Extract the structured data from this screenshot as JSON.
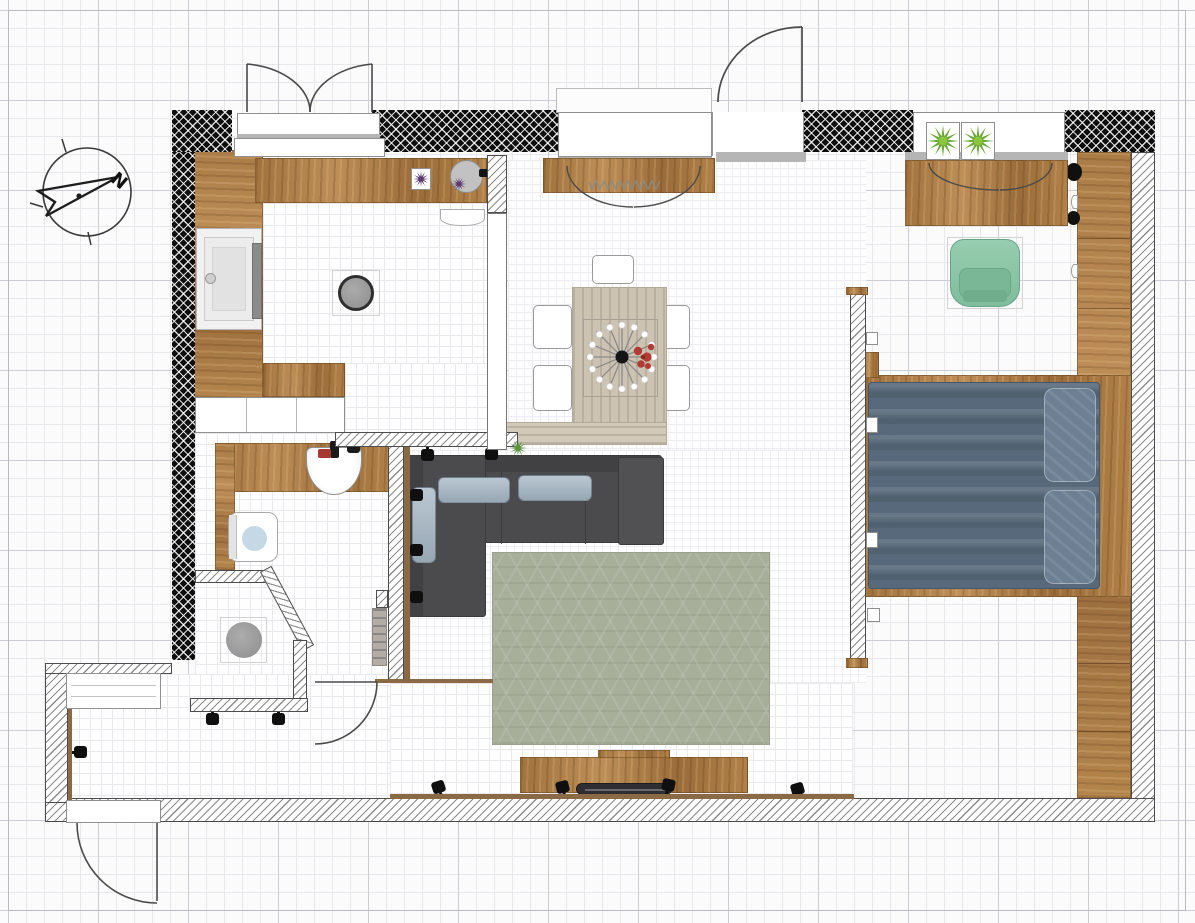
{
  "compass": {
    "label": "N"
  },
  "grid": {
    "minor_px": 18,
    "major_px": 90
  },
  "palette": {
    "exterior_wall": "#0e0e0e",
    "hatch_line": "#8a8a8a",
    "wood": "#a87a45",
    "wood_light": "#b5895a",
    "tile_line": "#e9e9ed",
    "grid_minor": "#e7e7ec",
    "grid_major": "#cdcdd5",
    "sofa": "#4b4b4d",
    "sofa_pillow": "#a3b5c3",
    "bed_duvet": "#57697a",
    "rug": "#a7af9b",
    "armchair_green": "#8cc6a8",
    "plant_green": "#67a832",
    "flower_purple": "#5c3a6e",
    "accent_red": "#b23b33",
    "table_beige": "#cdc3b3",
    "sill_gray": "#b5b5b5"
  },
  "rooms": [
    {
      "name": "kitchen"
    },
    {
      "name": "living-dining-room"
    },
    {
      "name": "bedroom"
    },
    {
      "name": "bathroom"
    },
    {
      "name": "shower"
    },
    {
      "name": "entry-vestibule"
    },
    {
      "name": "hallway"
    }
  ],
  "inventory": {
    "kitchen": [
      "l-shaped-counter",
      "large-sink",
      "round-sink",
      "stool",
      "base-cabinets",
      "flower-pots",
      "radiator"
    ],
    "living": [
      "dining-table",
      "five-chairs",
      "centerpiece",
      "sideboard",
      "corner-sofa",
      "three-pillows",
      "area-rug",
      "tv-console",
      "tv",
      "wall-lights"
    ],
    "bedroom": [
      "double-bed",
      "two-pillows",
      "wardrobe",
      "desk-dresser",
      "green-armchair",
      "two-potted-plants",
      "partition-wall"
    ],
    "bathroom": [
      "vanity",
      "washbasin",
      "toilet",
      "towel-radiator",
      "shower-enclosure",
      "shower-stool"
    ],
    "openings": [
      "balcony-double-door",
      "living-window",
      "entry-door-top",
      "bedroom-window",
      "bathroom-door",
      "vestibule-door",
      "vestibule-window"
    ]
  }
}
